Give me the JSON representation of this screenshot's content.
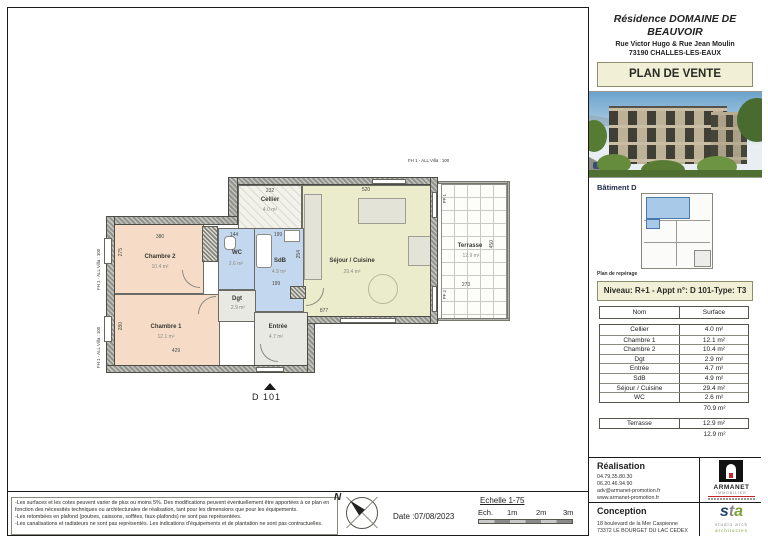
{
  "colors": {
    "cream_box": "#f1efd6",
    "room_bedroom": "#f6dcc6",
    "room_bath": "#c3d7ee",
    "room_living": "#ebeccb",
    "room_hall": "#e9e9e3",
    "keyplan_highlight": "#a9c9e9",
    "armanet_red": "#c4252b",
    "sta_blue": "#27406e",
    "sta_green": "#7aa234"
  },
  "sidebar": {
    "title": "Résidence DOMAINE DE BEAUVOIR",
    "address_line1": "Rue Victor Hugo & Rue Jean Moulin",
    "address_line2": "73190 CHALLES-LES-EAUX",
    "plan_de_vente": "PLAN DE VENTE",
    "batiment_label": "Bâtiment D",
    "plan_reperage_label": "Plan de repérage",
    "niveau_line": "Niveau: R+1 - Appt n°: D 101-Type: T3",
    "table": {
      "col_nom": "Nom",
      "col_surface": "Surface",
      "rows": [
        {
          "nom": "Cellier",
          "surface": "4.0 m²"
        },
        {
          "nom": "Chambre 1",
          "surface": "12.1 m²"
        },
        {
          "nom": "Chambre 2",
          "surface": "10.4 m²"
        },
        {
          "nom": "Dgt",
          "surface": "2.9 m²"
        },
        {
          "nom": "Entrée",
          "surface": "4.7 m²"
        },
        {
          "nom": "SdB",
          "surface": "4.9 m²"
        },
        {
          "nom": "Séjour / Cuisine",
          "surface": "29.4 m²"
        },
        {
          "nom": "WC",
          "surface": "2.6 m²"
        }
      ],
      "total": "70.9 m²",
      "terrasse_row": {
        "nom": "Terrasse",
        "surface": "12.9 m²"
      },
      "terrasse_total": "12.9 m²"
    },
    "realisation": {
      "label": "Réalisation",
      "phone1": "04.79.35.80.30",
      "phone2": "06.20.46.94.90",
      "email": "adv@armanet-promotion.fr",
      "website": "www.armanet-promotion.fr",
      "logo_text": "ARMANET",
      "logo_subtext": "IMMOBILIER"
    },
    "conception": {
      "label": "Conception",
      "address_line1": "18 boulevard de la Mer Caspienne",
      "address_line2": "73372 LE BOURGET DU LAC CEDEX",
      "logo_s": "s",
      "logo_t": "t",
      "logo_a": "a",
      "logo_sub1": "studio arch",
      "logo_sub2": "architectes"
    }
  },
  "plan": {
    "apartment_label": "D 101",
    "window_label": "FH 1 - ALL Villa : 100",
    "pf_labels": [
      "PF 1",
      "PF 2"
    ],
    "rooms": [
      {
        "name": "Cellier",
        "area": "4.0 m²"
      },
      {
        "name": "Chambre 1",
        "area": "12.1 m²"
      },
      {
        "name": "Chambre 2",
        "area": "10.4 m²"
      },
      {
        "name": "Dgt",
        "area": "2.9 m²"
      },
      {
        "name": "Entrée",
        "area": "4.7 m²"
      },
      {
        "name": "SdB",
        "area": "4.9 m²"
      },
      {
        "name": "Séjour / Cuisine",
        "area": "29.4 m²"
      },
      {
        "name": "WC",
        "area": "2.6 m²"
      },
      {
        "name": "Terrasse",
        "area": "12.9 m²"
      }
    ],
    "dims": {
      "cellier_w": "232",
      "sejour_w": "520",
      "chambre2_w": "380",
      "chambre2_h": "275",
      "wc_w": "144",
      "sdb_w": "199",
      "sdb_h": "254",
      "sdb_w2": "199",
      "chambre1_w": "429",
      "chambre1_h": "280",
      "sejour_s": "877",
      "terrasse_w": "273",
      "terrasse_h": "450"
    }
  },
  "footer": {
    "disclaimer1": "-Les surfaces et les cotes peuvent varier de plus ou moins 5%. Des modifications peuvent éventuellement être apportées à ce plan en fonction des nécessités techniques ou architecturales de réalisation, tant pour les dimensions que pour les équipements.",
    "disclaimer2": "-Les retombées en plafond (poutres, caissons, soffites, faux-plafonds) ne sont pas représentées.",
    "disclaimer3": "-Les canalisations et radiateurs ne sont pas représentés. Les indications d'équipements et de plantation ne sont pas contractuelles.",
    "north_label": "N",
    "date_label": "Date :07/08/2023",
    "scale_title": "Echelle 1-75",
    "scale_prefix": "Ech.",
    "scale_marks": [
      "1m",
      "2m",
      "3m"
    ]
  }
}
